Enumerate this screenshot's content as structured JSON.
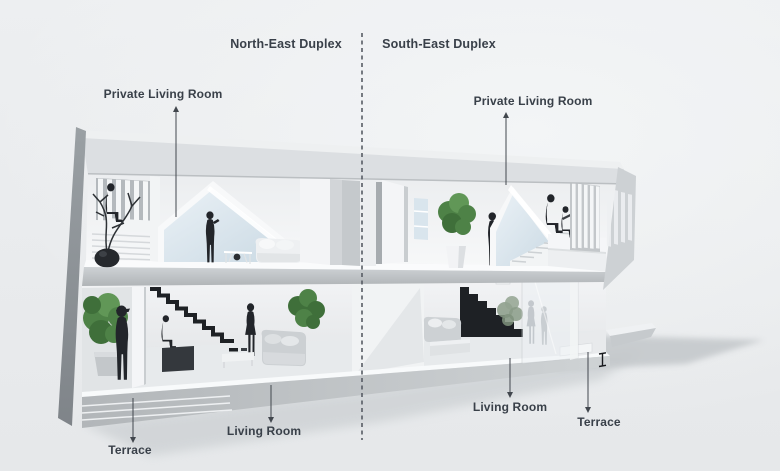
{
  "header": {
    "left_title": "North-East Duplex",
    "right_title": "South-East Duplex"
  },
  "labels": [
    {
      "id": "private-living-room-left",
      "text": "Private Living Room"
    },
    {
      "id": "private-living-room-right",
      "text": "Private Living Room"
    },
    {
      "id": "living-room-left",
      "text": "Living Room"
    },
    {
      "id": "terrace-left",
      "text": "Terrace"
    },
    {
      "id": "living-room-right",
      "text": "Living Room"
    },
    {
      "id": "terrace-right",
      "text": "Terrace"
    }
  ],
  "colors": {
    "background_top": "#f3f5f6",
    "background_bottom": "#e6e8ea",
    "heading_text": "#394049",
    "leader_line": "#42474e",
    "divider_line": "#575c64",
    "person_silhouette": "#22252a",
    "stair_black": "#1e2125",
    "plant_green": "#4e8247",
    "plant_green_dark": "#3f6f3a",
    "plant_green_light": "#619757",
    "glass_blue": "#d9e5ed",
    "building_white": "#f6f7f8",
    "concrete_gray": "#c6cacd",
    "shadow_gray": "#c3c7ca"
  },
  "scene": {
    "type": "architectural-cutaway-section",
    "divider_style": "vertical-dashed",
    "units": [
      {
        "id": "north-east-duplex",
        "upper_floor_label": "Private Living Room",
        "lower_floor_label": "Living Room",
        "outdoor_label": "Terrace",
        "upper_objects": [
          "louver-window",
          "stair-treads",
          "seated-person",
          "bonsai-plant",
          "gable-skylight",
          "standing-person",
          "white-sofa",
          "side-table-with-sphere"
        ],
        "lower_objects": [
          "terrace-plant",
          "terrace-standing-person",
          "black-zigzag-staircase",
          "person-seated-on-bench",
          "standing-person",
          "gray-sofa",
          "indoor-plant",
          "coffee-table"
        ]
      },
      {
        "id": "south-east-duplex",
        "upper_floor_label": "Private Living Room",
        "lower_floor_label": "Living Room",
        "outdoor_label": "Terrace",
        "upper_objects": [
          "open-door",
          "window",
          "potted-plant",
          "standing-person",
          "gable-skylight",
          "floating-stair-treads",
          "seated-person-with-laptop",
          "louver-window"
        ],
        "lower_objects": [
          "black-staircase",
          "gray-sofa",
          "coffee-table",
          "glass-wall",
          "silhouettes-behind-glass",
          "terrace-slab",
          "glass-railing-bracket"
        ]
      }
    ]
  }
}
